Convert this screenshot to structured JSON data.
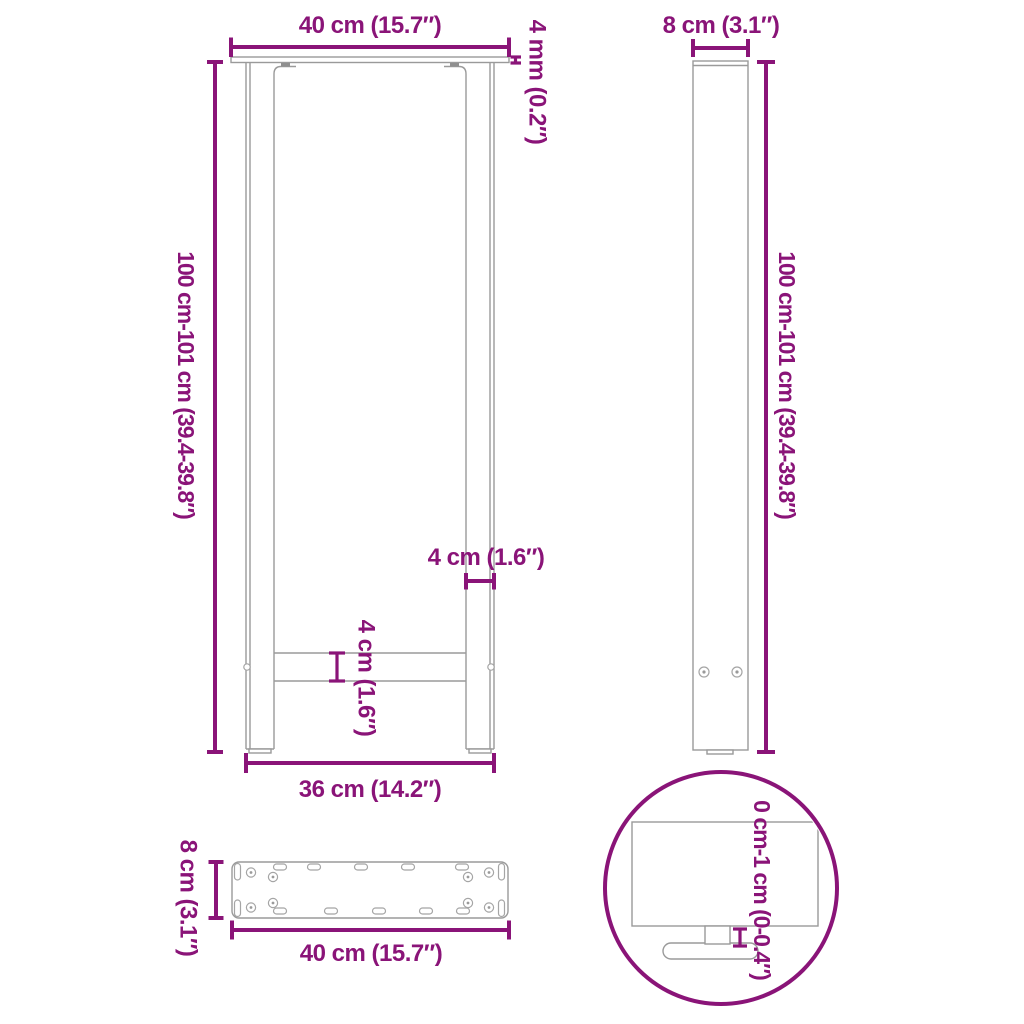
{
  "colors": {
    "dimension_accent": "#8A1478",
    "drawing_line": "#9A9A9A",
    "background": "#FFFFFF"
  },
  "front_view": {
    "top_width_label": "40 cm (15.7″)",
    "plate_thickness_label": "4 mm (0.2″)",
    "height_label": "100 cm-101 cm (39.4-39.8″)",
    "leg_width_label": "4 cm (1.6″)",
    "crossbar_label": "4 cm (1.6″)",
    "bottom_width_label": "36 cm (14.2″)"
  },
  "side_view": {
    "depth_label": "8 cm (3.1″)",
    "height_label": "100 cm-101 cm (39.4-39.8″)"
  },
  "plate_view": {
    "depth_label": "8 cm (3.1″)",
    "width_label": "40 cm (15.7″)"
  },
  "detail_view": {
    "adjustment_label": "0 cm-1 cm (0-0.4″)"
  }
}
